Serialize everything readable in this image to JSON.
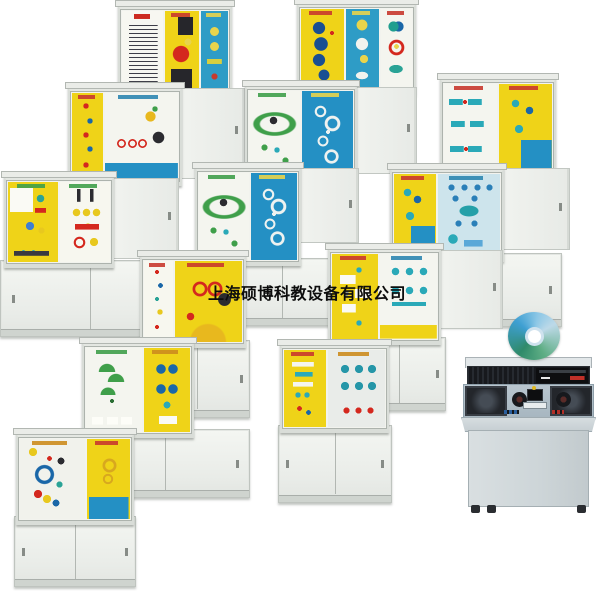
{
  "meta": {
    "width": 600,
    "height": 591,
    "background": "#ffffff"
  },
  "watermark": {
    "text": "上海硕博科教设备有限公司",
    "color": "#0d0d0d",
    "x": 208,
    "y": 280,
    "font_size": 16
  },
  "palette": {
    "panel_yellow": "#efd318",
    "panel_blue": "#2e9cc6",
    "panel_blue_deep": "#2490c4",
    "panel_white": "#f4f5ef",
    "cabinet_frame": "#e4e7e2",
    "cupboard": "#edf0ec",
    "accent_red": "#d4281e",
    "accent_teal": "#2aa9b8",
    "accent_navy": "#1a67a8",
    "accent_green": "#3f9f4a",
    "disc_teal": "#3e9fd2",
    "console_dark": "#17191d",
    "console_surface": "#b0bfc9"
  },
  "cabinets": [
    {
      "id": "a1",
      "x": 118,
      "y": 4,
      "disp": {
        "x": 0,
        "y": 0,
        "w": 110,
        "h": 87,
        "panels": [
          {
            "color": "#f7f7f1",
            "motif": "mf-text",
            "flex": 40
          },
          {
            "color": "#efd318",
            "motif": "mf-sew",
            "flex": 34
          },
          {
            "color": "#2e9cc6",
            "motif": "mf-bluebits",
            "flex": 26
          }
        ]
      }
    },
    {
      "id": "a2",
      "x": 297,
      "y": 2,
      "disp": {
        "x": 0,
        "y": 0,
        "w": 115,
        "h": 84,
        "panels": [
          {
            "color": "#efd318",
            "motif": "mf-cams",
            "flex": 40
          },
          {
            "color": "#2e9cc6",
            "motif": "mf-bluemix",
            "flex": 31
          },
          {
            "color": "#f4f5ef",
            "motif": "mf-pairs",
            "flex": 29
          }
        ]
      }
    },
    {
      "id": "b1",
      "x": 68,
      "y": 85,
      "disp": {
        "x": 0,
        "y": 1,
        "w": 110,
        "h": 91,
        "panels": [
          {
            "color": "#efd318",
            "motif": "mf-links",
            "flex": 30
          },
          {
            "color": "#f4f5ef",
            "motif": "mf-linkage",
            "flex": 70
          }
        ]
      },
      "door": {
        "x": 110,
        "y": 3,
        "w": 65,
        "h": 89
      }
    },
    {
      "id": "b2",
      "x": 245,
      "y": 84,
      "disp": {
        "x": 0,
        "y": 0,
        "w": 108,
        "h": 90,
        "panels": [
          {
            "color": "#f4f5ef",
            "motif": "mf-chain",
            "flex": 50
          },
          {
            "color": "#2490c4",
            "motif": "mf-belts",
            "flex": 50
          }
        ]
      },
      "door": {
        "x": 108,
        "y": 3,
        "w": 62,
        "h": 85
      }
    },
    {
      "id": "b3",
      "x": 440,
      "y": 77,
      "disp": {
        "x": 0,
        "y": 0,
        "w": 112,
        "h": 91,
        "panels": [
          {
            "color": "#f4f5ef",
            "motif": "mf-coup",
            "flex": 50
          },
          {
            "color": "#efd318",
            "motif": "mf-coup2",
            "flex": 50
          }
        ]
      }
    },
    {
      "id": "c1",
      "x": 0,
      "y": 175,
      "disp": {
        "x": 4,
        "y": 0,
        "w": 106,
        "h": 84,
        "panels": [
          {
            "color": "#efd318",
            "motif": "mf-scatter",
            "flex": 50
          },
          {
            "color": "#f7f7ef",
            "motif": "mf-scatter2",
            "flex": 50
          }
        ]
      },
      "door": {
        "x": 110,
        "y": 3,
        "w": 67,
        "h": 79
      },
      "cupb": {
        "x": 0,
        "y": 85,
        "w": 177,
        "h": 75
      }
    },
    {
      "id": "c2",
      "x": 195,
      "y": 166,
      "disp": {
        "x": 0,
        "y": 0,
        "w": 102,
        "h": 91,
        "panels": [
          {
            "color": "#f4f5ef",
            "motif": "mf-chain",
            "flex": 52
          },
          {
            "color": "#2490c4",
            "motif": "mf-belts",
            "flex": 48
          }
        ]
      },
      "door": {
        "x": 102,
        "y": 2,
        "w": 60,
        "h": 73
      },
      "cupb": {
        "x": 8,
        "y": 92,
        "w": 155,
        "h": 66
      }
    },
    {
      "id": "c3",
      "x": 388,
      "y": 163,
      "disp": {
        "x": 2,
        "y": 4,
        "w": 110,
        "h": 86,
        "panels": [
          {
            "color": "#efd318",
            "motif": "mf-coup2",
            "flex": 40
          },
          {
            "color": "#cde4ec",
            "motif": "mf-tealrows",
            "flex": 60
          }
        ]
      },
      "door": {
        "x": 112,
        "y": 5,
        "w": 68,
        "h": 80
      },
      "cupb": {
        "x": 14,
        "y": 90,
        "w": 158,
        "h": 72
      }
    },
    {
      "id": "d1",
      "x": 140,
      "y": 254,
      "disp": {
        "x": 0,
        "y": 0,
        "w": 102,
        "h": 85,
        "panels": [
          {
            "color": "#f7f7ef",
            "motif": "mf-smallparts",
            "flex": 30
          },
          {
            "color": "#efd318",
            "motif": "mf-gears",
            "flex": 70
          }
        ]
      },
      "cupb": {
        "x": 4,
        "y": 86,
        "w": 104,
        "h": 76
      }
    },
    {
      "id": "d2",
      "x": 328,
      "y": 247,
      "disp": {
        "x": 0,
        "y": 0,
        "w": 109,
        "h": 89,
        "panels": [
          {
            "color": "#efd318",
            "motif": "mf-cards",
            "flex": 45
          },
          {
            "color": "#f4f5ef",
            "motif": "mf-tees",
            "flex": 55
          }
        ]
      },
      "door": {
        "x": 109,
        "y": 3,
        "w": 64,
        "h": 77
      },
      "cupb": {
        "x": 24,
        "y": 90,
        "w": 92,
        "h": 72
      }
    },
    {
      "id": "e1",
      "x": 80,
      "y": 341,
      "disp": {
        "x": 2,
        "y": 0,
        "w": 108,
        "h": 88,
        "panels": [
          {
            "color": "#f4f5ef",
            "motif": "mf-umb",
            "flex": 55
          },
          {
            "color": "#efd318",
            "motif": "mf-bear",
            "flex": 45
          }
        ]
      },
      "cupb": {
        "x": 0,
        "y": 88,
        "w": 168,
        "h": 67
      }
    },
    {
      "id": "e2",
      "x": 278,
      "y": 342,
      "disp": {
        "x": 2,
        "y": 1,
        "w": 105,
        "h": 81,
        "panels": [
          {
            "color": "#efd318",
            "motif": "mf-bars",
            "flex": 42
          },
          {
            "color": "#e9ece9",
            "motif": "mf-spin",
            "flex": 58
          }
        ]
      },
      "cupb": {
        "x": 0,
        "y": 83,
        "w": 112,
        "h": 76
      }
    },
    {
      "id": "f1",
      "x": 14,
      "y": 430,
      "disp": {
        "x": 2,
        "y": 2,
        "w": 114,
        "h": 84,
        "panels": [
          {
            "color": "#f1f2ec",
            "motif": "mf-wheels",
            "flex": 60
          },
          {
            "color": "#efd318",
            "motif": "mf-gearcard",
            "flex": 40
          }
        ]
      },
      "cupb": {
        "x": 0,
        "y": 86,
        "w": 120,
        "h": 69
      }
    }
  ],
  "console": {
    "x": 461,
    "y": 357,
    "w": 135,
    "h": 160
  },
  "disc": {
    "cx": 534,
    "cy": 336,
    "rx": 26,
    "ry": 24
  }
}
